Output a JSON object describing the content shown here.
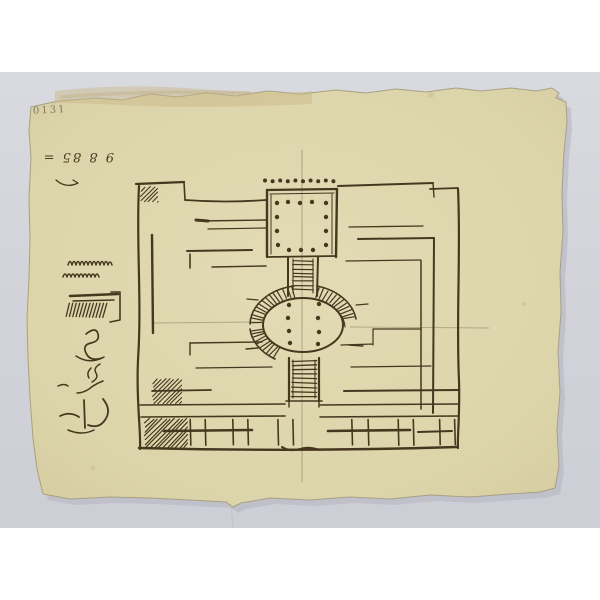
{
  "artwork": {
    "corner_inscription": "0131",
    "reversed_inscription": "9 8 85 =",
    "palette": {
      "frame": "#ffffff",
      "backdrop": "#d4d5dc",
      "paper": "#ddd5ab",
      "paper_edge": "#a8a083",
      "ink": "#46371f",
      "pencil": "#8d856d",
      "stain": "#c7b686"
    }
  }
}
